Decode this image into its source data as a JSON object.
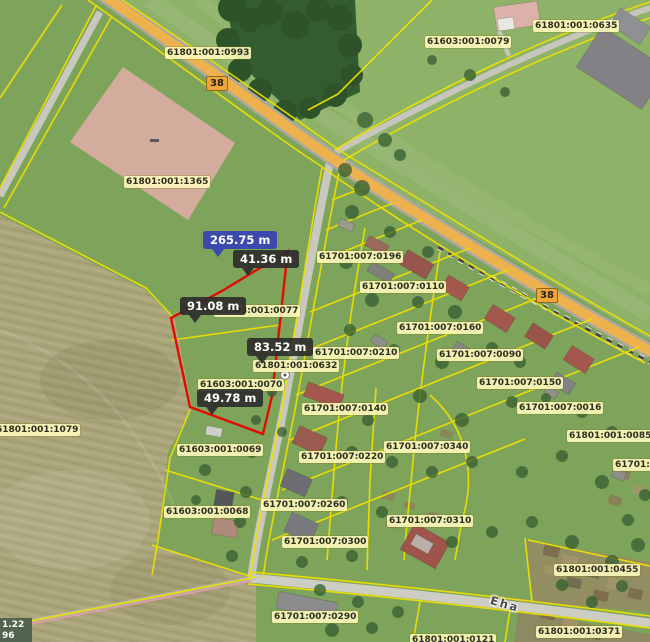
{
  "map": {
    "parcel_labels": [
      {
        "text": "61801:001:0993",
        "x": 165,
        "y": 47
      },
      {
        "text": "61603:001:0079",
        "x": 425,
        "y": 36
      },
      {
        "text": "61801:001:0635",
        "x": 533,
        "y": 20
      },
      {
        "text": "61801:001:1365",
        "x": 124,
        "y": 176
      },
      {
        "text": "61603:001:0077",
        "x": 214,
        "y": 305
      },
      {
        "text": "61801:001:0632",
        "x": 253,
        "y": 360
      },
      {
        "text": "61603:001:0070",
        "x": 198,
        "y": 379
      },
      {
        "text": "61701:007:0196",
        "x": 317,
        "y": 251
      },
      {
        "text": "61701:007:0110",
        "x": 360,
        "y": 281
      },
      {
        "text": "61701:007:0160",
        "x": 397,
        "y": 322
      },
      {
        "text": "61701:007:0210",
        "x": 313,
        "y": 347
      },
      {
        "text": "61701:007:0090",
        "x": 437,
        "y": 349
      },
      {
        "text": "61701:007:0150",
        "x": 477,
        "y": 377
      },
      {
        "text": "61701:007:0016",
        "x": 517,
        "y": 402
      },
      {
        "text": "61801:001:0085",
        "x": 567,
        "y": 430
      },
      {
        "text": "61701:00",
        "x": 613,
        "y": 459
      },
      {
        "text": "61801:001:1079",
        "x": -6,
        "y": 424
      },
      {
        "text": "61603:001:0069",
        "x": 177,
        "y": 444
      },
      {
        "text": "61701:007:0140",
        "x": 302,
        "y": 403
      },
      {
        "text": "61701:007:0340",
        "x": 384,
        "y": 441
      },
      {
        "text": "61701:007:0220",
        "x": 299,
        "y": 451
      },
      {
        "text": "61701:007:0260",
        "x": 261,
        "y": 499
      },
      {
        "text": "61603:001:0068",
        "x": 164,
        "y": 506
      },
      {
        "text": "61701:007:0310",
        "x": 387,
        "y": 515
      },
      {
        "text": "61701:007:0300",
        "x": 282,
        "y": 536
      },
      {
        "text": "61801:001:0455",
        "x": 554,
        "y": 564
      },
      {
        "text": "61701:007:0290",
        "x": 272,
        "y": 611
      },
      {
        "text": "61801:001:0371",
        "x": 536,
        "y": 626
      },
      {
        "text": "61801:001:0121",
        "x": 410,
        "y": 634
      }
    ],
    "measurements": [
      {
        "text": "265.75 m",
        "x": 203,
        "y": 231,
        "selected": true
      },
      {
        "text": "41.36 m",
        "x": 233,
        "y": 250,
        "selected": false
      },
      {
        "text": "91.08 m",
        "x": 180,
        "y": 297,
        "selected": false
      },
      {
        "text": "83.52 m",
        "x": 247,
        "y": 338,
        "selected": false
      },
      {
        "text": "49.78 m",
        "x": 197,
        "y": 389,
        "selected": false
      }
    ],
    "road_badges": [
      {
        "text": "38",
        "x": 206,
        "y": 76
      },
      {
        "text": "38",
        "x": 536,
        "y": 288
      }
    ],
    "street_label": {
      "text": "Eha",
      "x": 490,
      "y": 597,
      "rotation": 16
    },
    "coordinate_readout": {
      "line1": "1.22",
      "line2": "96"
    },
    "colors": {
      "parcel_line": "#eee000",
      "highlight_outline": "#e30b00",
      "selected_measure_bg": "#3c49ae",
      "measure_bg": "#2b2b2b",
      "label_bg": "#fffbbe",
      "road_badge_bg": "#f1a53b",
      "highway_fill": "#edb24e"
    }
  }
}
